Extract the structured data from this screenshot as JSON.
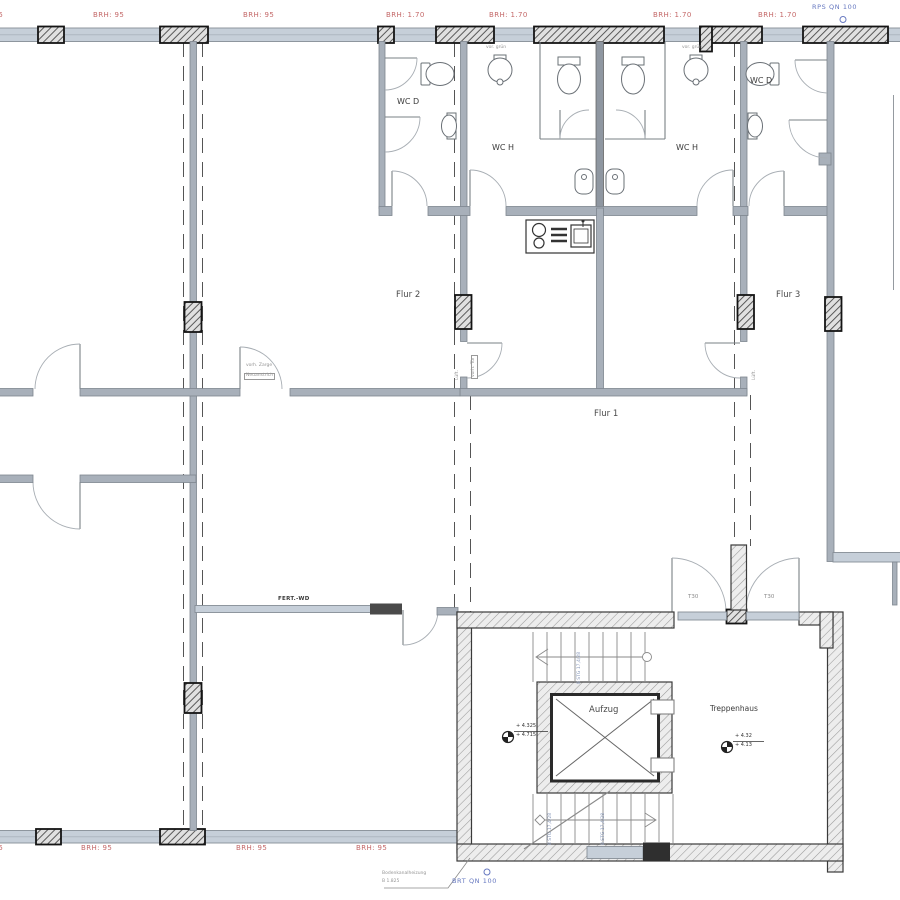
{
  "labels": {
    "rooms": [
      {
        "text": "WC D"
      },
      {
        "text": "WC H"
      },
      {
        "text": "WC H"
      },
      {
        "text": "WC D"
      },
      {
        "text": "Flur 2"
      },
      {
        "text": "Flur 3"
      },
      {
        "text": "Flur 1"
      },
      {
        "text": "Aufzug"
      },
      {
        "text": "Treppenhaus"
      }
    ],
    "sills_top": [
      "BRH: 95",
      "BRH: 95",
      "BRH: 95",
      "BRH: 1.70",
      "BRH: 1.70",
      "BRH: 1.70",
      "BRH: 1.70"
    ],
    "sills_bottom": [
      "BRH: 95",
      "BRH: 95",
      "BRH: 95",
      "BRH: 95"
    ],
    "vents": {
      "top": "RPS QN 100",
      "bottom": "BRT QN 100"
    },
    "fire_doors": [
      "T30",
      "T30"
    ],
    "stair_run_text": "8 STG 17,4/28",
    "levels": {
      "elevator_upper": "+ 4.325",
      "elevator_lower": "+ 4.715",
      "stair_upper": "+ 4.32",
      "stair_lower": "+ 4.13"
    },
    "notes": {
      "wall_type": "FERT.-WD",
      "door_note_1": "vorh. Zarge",
      "door_note_2": "Neuanstrich",
      "basin_note_left": "vor. grün",
      "basin_note_right": "vor. grün",
      "duct_note_1": "Bodenkanalheizung",
      "duct_note_2": "B 1.825",
      "vent_shaft_left": "Lüft.",
      "vent_shaft_left_box": "vorh. Tür",
      "vent_shaft_right": "Lüft."
    }
  },
  "colors": {
    "wall_fill": "#c6cfd9",
    "sill_red": "#c46868",
    "vent_blue": "#6678c0",
    "line_gray": "#8a929c"
  }
}
